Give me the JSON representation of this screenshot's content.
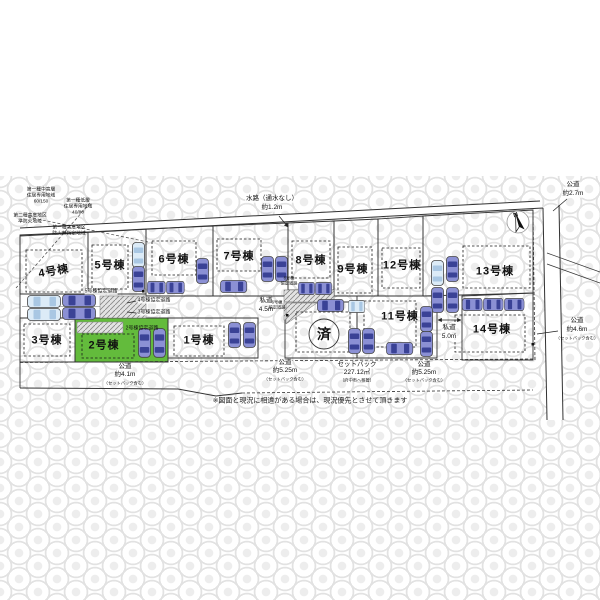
{
  "colors": {
    "green_lot": "#63bb3c",
    "car_purple": "#8b90d4",
    "car_blue": "#dcebf7"
  },
  "compass": {
    "north": "N"
  },
  "zoning": {
    "a1": "第一種中高層",
    "a2": "住居専用地域",
    "a3": "60/150",
    "b1": "第一種低層",
    "b2": "住居専用地域",
    "b3": "40/80",
    "c1": "第二種高度地区",
    "c2": "準防火地域",
    "d1": "第一種高度地区",
    "d2": "防火無指定地域"
  },
  "lots": {
    "l1": "1号棟",
    "l2": "2号棟",
    "l3": "3号棟",
    "l4": "4号棟",
    "l5": "5号棟",
    "l6": "6号棟",
    "l7": "7号棟",
    "l8": "8号棟",
    "l9": "9号棟",
    "l11": "11号棟",
    "l12": "12号棟",
    "l13": "13号棟",
    "l14": "14号棟",
    "sold": "済"
  },
  "roads": {
    "waterway1": "水路（通水なし）",
    "waterway2": "約1.2m",
    "east1": "公道",
    "east2": "約2.7m",
    "southeast1": "公道",
    "southeast2": "約4.6m",
    "southeast3": "（セットバック含む）",
    "south_a1": "公道",
    "south_a2": "約4.1m",
    "south_a3": "（セットバック含む）",
    "south_b1": "公道",
    "south_b2": "約5.25m",
    "south_b3": "（セットバック含む）",
    "setback1": "セットバック",
    "setback2": "227.12㎡",
    "setback3": "（府中市へ移管）",
    "south_c1": "公道",
    "south_c2": "約5.25m",
    "south_c3": "（セットバック含む）",
    "private_center1": "私道",
    "private_center2": "4.5m",
    "private_east1": "私道",
    "private_east2": "5.0m"
  },
  "agreement_roads": {
    "r5": "5号棟協定道路",
    "r4": "4号棟協定道路",
    "r3": "3号棟協定道路",
    "r2": "2号棟協定道路",
    "r8a": "8号棟",
    "r8b": "協定道路",
    "r6a": "6号棟",
    "r6b": "協定道路"
  },
  "disclaimer": "※図面と現況に相違がある場合は、現況優先とさせて頂きます"
}
